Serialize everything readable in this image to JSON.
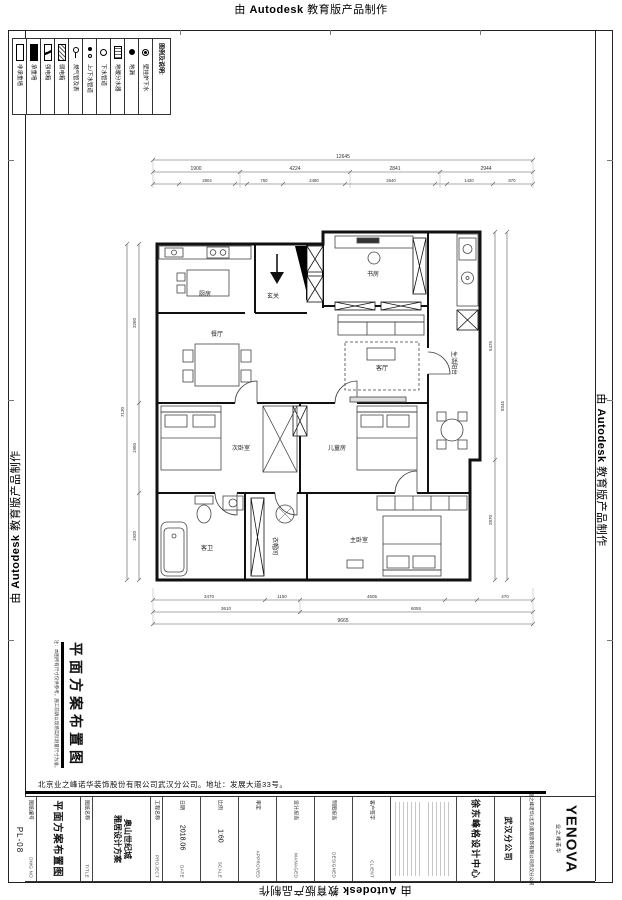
{
  "banner": {
    "prefix": "由",
    "brand": "Autodesk",
    "suffix": "教育版产品制作"
  },
  "legend": {
    "header": "图例及说明:",
    "items": [
      {
        "label": "非承重墙",
        "icon": "non-bearing-wall"
      },
      {
        "label": "承重墙",
        "icon": "bearing-wall"
      },
      {
        "label": "强电箱",
        "icon": "strong-power-box"
      },
      {
        "label": "弱电箱",
        "icon": "weak-power-box"
      },
      {
        "label": "燃气管及表",
        "icon": "gas-pipe-meter"
      },
      {
        "label": "上/下水管道",
        "icon": "supply-drain-pipes"
      },
      {
        "label": "下水管道",
        "icon": "drain-pipe"
      },
      {
        "label": "地暖分水器",
        "icon": "floor-heating-manifold"
      },
      {
        "label": "地漏",
        "icon": "floor-drain"
      },
      {
        "label": "壁挂炉下水",
        "icon": "boiler-drain"
      }
    ]
  },
  "plan": {
    "rooms": {
      "kitchen": "厨房",
      "entry": "玄关",
      "study": "书房",
      "utility": "生活阳台",
      "living": "客厅",
      "dining": "餐厅",
      "bedroom": "次卧室",
      "kids": "儿童房",
      "bath": "客卫",
      "closet": "衣帽间",
      "master": "主卧室"
    },
    "dims": {
      "top_total": "12645",
      "top_main": [
        "1900",
        "4224",
        "2841",
        "2944"
      ],
      "top_sub": [
        "2804",
        "760",
        "2480",
        "2640",
        "1420",
        "870"
      ],
      "bottom_sub": [
        "3470",
        "1150",
        "4605",
        "470"
      ],
      "bottom_main": [
        "3610",
        "6055"
      ],
      "bottom_total": "9665",
      "left": [
        "3260",
        "1950",
        "1920"
      ],
      "left_total": "7130",
      "right": [
        "5475",
        "2870"
      ],
      "right_total": "8345"
    }
  },
  "footer": {
    "sheet_title": "平面方案布置图",
    "note": "注：本图所有尺寸仅供参考，施工前请以现场实际测量尺寸为准。",
    "address": "北京业之峰诺华装饰股份有限公司武汉分公司。地址：发展大道33号。",
    "sheet_no": "PL-08"
  },
  "titleblock": {
    "dwg_no_zh": "图纸编号",
    "dwg_no_en": "DWG NO",
    "title_value": "平面方案布置图",
    "title_zh": "图纸名称",
    "title_en": "TITLE",
    "project_value_1": "奥山世纪城",
    "project_value_2": "雅居设计方案",
    "project_zh": "工程名称",
    "project_en": "PROJECT",
    "date_zh": "日期",
    "date_value": "2018.06",
    "date_en": "DATE",
    "scale_zh": "比例",
    "scale_value": "1:60",
    "scale_en": "SCALE",
    "approved_zh": "审定",
    "approved_en": "APPROVED",
    "managed_zh": "设计担当",
    "managed_en": "MANAGED",
    "designed_zh": "制图担当",
    "designed_en": "DESIGNED",
    "client_zh": "客户签字",
    "client_en": "CLIENT",
    "center_name": "徐东峰格设计中心",
    "branch": "武汉分公司",
    "company": "业之峰诺华(北京)家居装饰有限公司武汉分公司",
    "logo": "YENOVA",
    "logo_sub": "业之峰诺华"
  }
}
